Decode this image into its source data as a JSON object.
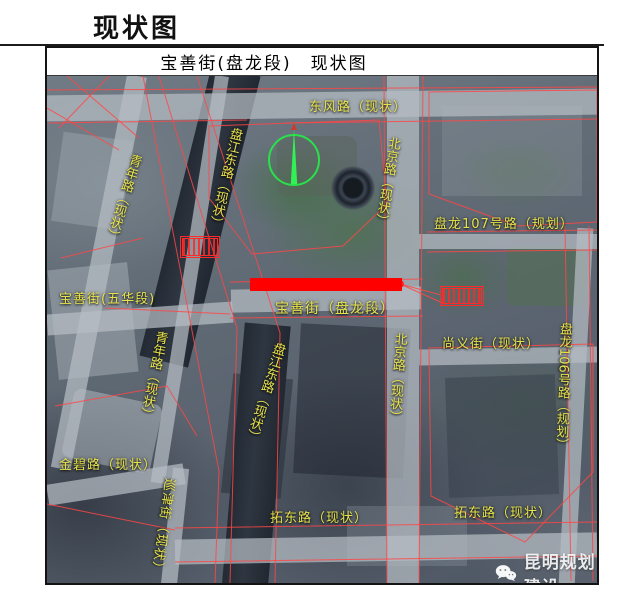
{
  "page_title": "现状图",
  "map": {
    "header_title": "宝善街(盘龙段)　现状图",
    "labels": {
      "dongfeng": "东风路（现状）",
      "beijing_top": "北京路（现状）",
      "beijing_bottom": "北京路（现状）",
      "qingnian_top": "青年路（现状）",
      "qingnian_bottom": "青年路（现状）",
      "panjiang_top": "盘江东路（现状）",
      "panjiang_bottom": "盘江东路（现状）",
      "baoshan_wuhua": "宝善街(五华段)",
      "baoshan_panlong": "宝善街（盘龙段）",
      "panlong107": "盘龙107号路（规划）",
      "shangyi": "尚义街（现状）",
      "panlong106": "盘龙106号路（规划）",
      "jinbi": "金碧路（现状）",
      "xunjin": "巡津街（现状）",
      "tuodong_left": "拓东路（现状）",
      "tuodong_right": "拓东路（现状）"
    },
    "colors": {
      "label_yellow": "#e6e24c",
      "highlight_red": "#ff0000",
      "outline_red": "#ff4646",
      "compass_green": "#2ae04b"
    }
  },
  "watermark": {
    "text": "昆明规划建设",
    "icon": "wechat-icon"
  }
}
